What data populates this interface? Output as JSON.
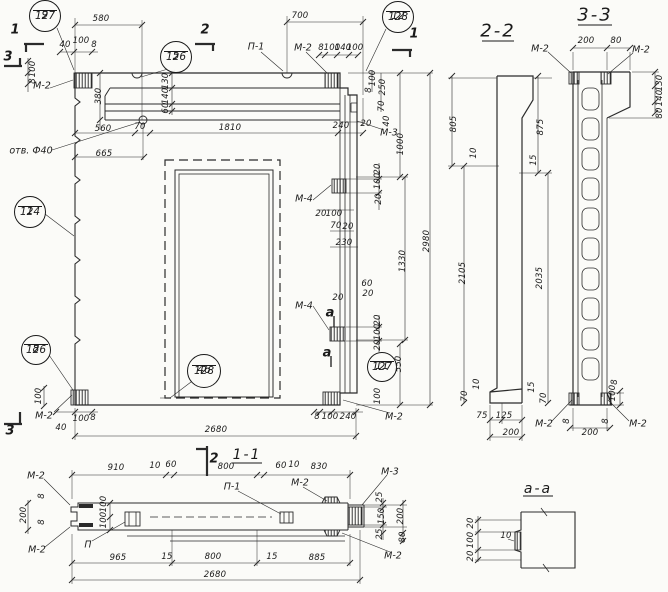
{
  "drawing": {
    "language": "ru",
    "type": "precast-concrete-panel-working-drawing"
  },
  "views": [
    {
      "id": "main-elevation",
      "title": null,
      "dims": [
        {
          "t": "580",
          "x": 101,
          "y": 19
        },
        {
          "t": "700",
          "x": 300,
          "y": 16
        },
        {
          "t": "40",
          "x": 65,
          "y": 45
        },
        {
          "t": "100",
          "x": 81,
          "y": 41
        },
        {
          "t": "8",
          "x": 94,
          "y": 45
        },
        {
          "t": "8",
          "x": 321,
          "y": 48
        },
        {
          "t": "100",
          "x": 332,
          "y": 48
        },
        {
          "t": "140",
          "x": 343,
          "y": 48
        },
        {
          "t": "100",
          "x": 355,
          "y": 48
        },
        {
          "t": "100",
          "x": 33,
          "y": 69,
          "rot": true
        },
        {
          "t": "8",
          "x": 33,
          "y": 81,
          "rot": true
        },
        {
          "t": "380",
          "x": 99,
          "y": 96,
          "rot": true
        },
        {
          "t": "130",
          "x": 166,
          "y": 81,
          "rot": true
        },
        {
          "t": "140",
          "x": 166,
          "y": 96,
          "rot": true
        },
        {
          "t": "60",
          "x": 166,
          "y": 108,
          "rot": true
        },
        {
          "t": "560",
          "x": 103,
          "y": 129
        },
        {
          "t": "70",
          "x": 140,
          "y": 127
        },
        {
          "t": "1810",
          "x": 230,
          "y": 128
        },
        {
          "t": "240",
          "x": 341,
          "y": 126
        },
        {
          "t": "665",
          "x": 104,
          "y": 154
        },
        {
          "t": "100",
          "x": 373,
          "y": 78,
          "rot": true
        },
        {
          "t": "8",
          "x": 369,
          "y": 90,
          "rot": true
        },
        {
          "t": "250",
          "x": 383,
          "y": 87,
          "rot": true
        },
        {
          "t": "70",
          "x": 382,
          "y": 106,
          "rot": true
        },
        {
          "t": "40",
          "x": 387,
          "y": 121,
          "rot": true
        },
        {
          "t": "20",
          "x": 366,
          "y": 124
        },
        {
          "t": "1000",
          "x": 401,
          "y": 144,
          "rot": true
        },
        {
          "t": "20",
          "x": 378,
          "y": 169,
          "rot": true
        },
        {
          "t": "100",
          "x": 378,
          "y": 181,
          "rot": true
        },
        {
          "t": "20",
          "x": 379,
          "y": 199,
          "rot": true
        },
        {
          "t": "20",
          "x": 321,
          "y": 214
        },
        {
          "t": "100",
          "x": 334,
          "y": 214
        },
        {
          "t": "70",
          "x": 336,
          "y": 226
        },
        {
          "t": "20",
          "x": 348,
          "y": 227
        },
        {
          "t": "230",
          "x": 344,
          "y": 243
        },
        {
          "t": "1330",
          "x": 403,
          "y": 261,
          "rot": true
        },
        {
          "t": "2980",
          "x": 427,
          "y": 241,
          "rot": true
        },
        {
          "t": "60",
          "x": 367,
          "y": 284
        },
        {
          "t": "20",
          "x": 368,
          "y": 294
        },
        {
          "t": "20",
          "x": 338,
          "y": 298
        },
        {
          "t": "20",
          "x": 378,
          "y": 320,
          "rot": true
        },
        {
          "t": "100",
          "x": 378,
          "y": 332,
          "rot": true
        },
        {
          "t": "20",
          "x": 378,
          "y": 345,
          "rot": true
        },
        {
          "t": "550",
          "x": 399,
          "y": 364,
          "rot": true
        },
        {
          "t": "100",
          "x": 378,
          "y": 396,
          "rot": true
        },
        {
          "t": "8",
          "x": 317,
          "y": 417
        },
        {
          "t": "100",
          "x": 330,
          "y": 417
        },
        {
          "t": "240",
          "x": 348,
          "y": 417
        },
        {
          "t": "40",
          "x": 61,
          "y": 428
        },
        {
          "t": "100",
          "x": 81,
          "y": 419
        },
        {
          "t": "8",
          "x": 93,
          "y": 418
        },
        {
          "t": "100",
          "x": 39,
          "y": 396,
          "rot": true
        },
        {
          "t": "2680",
          "x": 216,
          "y": 430
        }
      ],
      "labels": [
        {
          "t": "М-2",
          "x": 42,
          "y": 86
        },
        {
          "t": "П-1",
          "x": 256,
          "y": 47
        },
        {
          "t": "М-2",
          "x": 303,
          "y": 48
        },
        {
          "t": "М-3",
          "x": 389,
          "y": 133
        },
        {
          "t": "М-4",
          "x": 304,
          "y": 199
        },
        {
          "t": "М-4",
          "x": 304,
          "y": 306
        },
        {
          "t": "М-2",
          "x": 44,
          "y": 416
        },
        {
          "t": "М-2",
          "x": 394,
          "y": 417
        },
        {
          "t": "отв. Ф40",
          "x": 31,
          "y": 151
        }
      ],
      "marks": [
        {
          "t": "1",
          "x": 15,
          "y": 30
        },
        {
          "t": "2",
          "x": 205,
          "y": 30
        },
        {
          "t": "1",
          "x": 414,
          "y": 34
        },
        {
          "t": "3",
          "x": 8,
          "y": 57
        },
        {
          "t": "3",
          "x": 10,
          "y": 431
        },
        {
          "t": "а",
          "x": 330,
          "y": 313
        },
        {
          "t": "а",
          "x": 327,
          "y": 353
        }
      ],
      "callouts": [
        {
          "n": "9",
          "s": "127",
          "cx": 45,
          "cy": 16,
          "r": 16
        },
        {
          "n": "5",
          "s": "126",
          "cx": 176,
          "cy": 57,
          "r": 16
        },
        {
          "n": "12",
          "s": "128",
          "cx": 398,
          "cy": 17,
          "r": 16
        },
        {
          "n": "1",
          "s": "124",
          "cx": 30,
          "cy": 212,
          "r": 16
        },
        {
          "n": "8",
          "s": "126",
          "cx": 36,
          "cy": 350,
          "r": 15
        },
        {
          "n": "46",
          "s": "128",
          "cx": 204,
          "cy": 371,
          "r": 17
        },
        {
          "n": "11",
          "s": "127",
          "cx": 382,
          "cy": 367,
          "r": 15
        }
      ]
    },
    {
      "id": "section-1-1",
      "title": "1-1",
      "title_pos": {
        "x": 247,
        "y": 455
      },
      "title_small": true,
      "dims": [
        {
          "t": "910",
          "x": 116,
          "y": 468
        },
        {
          "t": "10",
          "x": 155,
          "y": 466
        },
        {
          "t": "60",
          "x": 171,
          "y": 465
        },
        {
          "t": "800",
          "x": 226,
          "y": 467
        },
        {
          "t": "60",
          "x": 281,
          "y": 466
        },
        {
          "t": "10",
          "x": 294,
          "y": 465
        },
        {
          "t": "830",
          "x": 319,
          "y": 467
        },
        {
          "t": "200",
          "x": 24,
          "y": 515,
          "rot": true
        },
        {
          "t": "8",
          "x": 42,
          "y": 496,
          "rot": true
        },
        {
          "t": "8",
          "x": 42,
          "y": 522,
          "rot": true
        },
        {
          "t": "100",
          "x": 104,
          "y": 504,
          "rot": true
        },
        {
          "t": "100",
          "x": 104,
          "y": 520,
          "rot": true
        },
        {
          "t": "25",
          "x": 380,
          "y": 497,
          "rot": true
        },
        {
          "t": "150",
          "x": 382,
          "y": 516,
          "rot": true
        },
        {
          "t": "25",
          "x": 380,
          "y": 534,
          "rot": true
        },
        {
          "t": "200",
          "x": 401,
          "y": 516,
          "rot": true
        },
        {
          "t": "80",
          "x": 403,
          "y": 537,
          "rot": true
        },
        {
          "t": "965",
          "x": 118,
          "y": 558
        },
        {
          "t": "15",
          "x": 167,
          "y": 557
        },
        {
          "t": "800",
          "x": 213,
          "y": 557
        },
        {
          "t": "15",
          "x": 272,
          "y": 557
        },
        {
          "t": "885",
          "x": 317,
          "y": 558
        },
        {
          "t": "2680",
          "x": 215,
          "y": 575
        }
      ],
      "labels": [
        {
          "t": "М-2",
          "x": 36,
          "y": 476
        },
        {
          "t": "М-2",
          "x": 37,
          "y": 550
        },
        {
          "t": "П",
          "x": 88,
          "y": 545
        },
        {
          "t": "П-1",
          "x": 232,
          "y": 487
        },
        {
          "t": "М-2",
          "x": 300,
          "y": 483
        },
        {
          "t": "М-3",
          "x": 390,
          "y": 472
        },
        {
          "t": "М-2",
          "x": 393,
          "y": 556
        }
      ],
      "marks": [
        {
          "t": "2",
          "x": 214,
          "y": 459
        }
      ],
      "callouts": []
    },
    {
      "id": "section-2-2",
      "title": "2-2",
      "title_pos": {
        "x": 498,
        "y": 31
      },
      "dims": [
        {
          "t": "805",
          "x": 454,
          "y": 124,
          "rot": true
        },
        {
          "t": "875",
          "x": 541,
          "y": 127,
          "rot": true
        },
        {
          "t": "10",
          "x": 474,
          "y": 153,
          "rot": true
        },
        {
          "t": "15",
          "x": 534,
          "y": 160,
          "rot": true
        },
        {
          "t": "2105",
          "x": 463,
          "y": 273,
          "rot": true
        },
        {
          "t": "2035",
          "x": 540,
          "y": 278,
          "rot": true
        },
        {
          "t": "10",
          "x": 477,
          "y": 384,
          "rot": true
        },
        {
          "t": "70",
          "x": 465,
          "y": 396,
          "rot": true
        },
        {
          "t": "75",
          "x": 482,
          "y": 416
        },
        {
          "t": "125",
          "x": 504,
          "y": 416
        },
        {
          "t": "200",
          "x": 511,
          "y": 433
        },
        {
          "t": "15",
          "x": 532,
          "y": 387,
          "rot": true
        },
        {
          "t": "70",
          "x": 544,
          "y": 398,
          "rot": true
        }
      ],
      "labels": [],
      "marks": [],
      "callouts": []
    },
    {
      "id": "section-3-3",
      "title": "3-3",
      "title_pos": {
        "x": 595,
        "y": 15
      },
      "dims": [
        {
          "t": "200",
          "x": 586,
          "y": 41
        },
        {
          "t": "80",
          "x": 616,
          "y": 41
        },
        {
          "t": "130",
          "x": 660,
          "y": 83,
          "rot": true
        },
        {
          "t": "140",
          "x": 660,
          "y": 98,
          "rot": true
        },
        {
          "t": "80",
          "x": 660,
          "y": 113,
          "rot": true
        },
        {
          "t": "8",
          "x": 615,
          "y": 382,
          "rot": true
        },
        {
          "t": "100",
          "x": 613,
          "y": 393,
          "rot": true
        },
        {
          "t": "8",
          "x": 567,
          "y": 421,
          "rot": true
        },
        {
          "t": "8",
          "x": 606,
          "y": 421,
          "rot": true
        },
        {
          "t": "200",
          "x": 590,
          "y": 433
        }
      ],
      "labels": [
        {
          "t": "М-2",
          "x": 540,
          "y": 49
        },
        {
          "t": "М-2",
          "x": 641,
          "y": 50
        },
        {
          "t": "М-2",
          "x": 544,
          "y": 424
        },
        {
          "t": "М-2",
          "x": 638,
          "y": 424
        }
      ],
      "marks": [],
      "callouts": []
    },
    {
      "id": "detail-a-a",
      "title": "а-а",
      "title_pos": {
        "x": 538,
        "y": 489
      },
      "title_small": true,
      "dims": [
        {
          "t": "20",
          "x": 471,
          "y": 523,
          "rot": true
        },
        {
          "t": "100",
          "x": 471,
          "y": 540,
          "rot": true
        },
        {
          "t": "20",
          "x": 471,
          "y": 556,
          "rot": true
        },
        {
          "t": "10",
          "x": 506,
          "y": 536
        }
      ],
      "labels": [],
      "marks": [],
      "callouts": []
    }
  ]
}
